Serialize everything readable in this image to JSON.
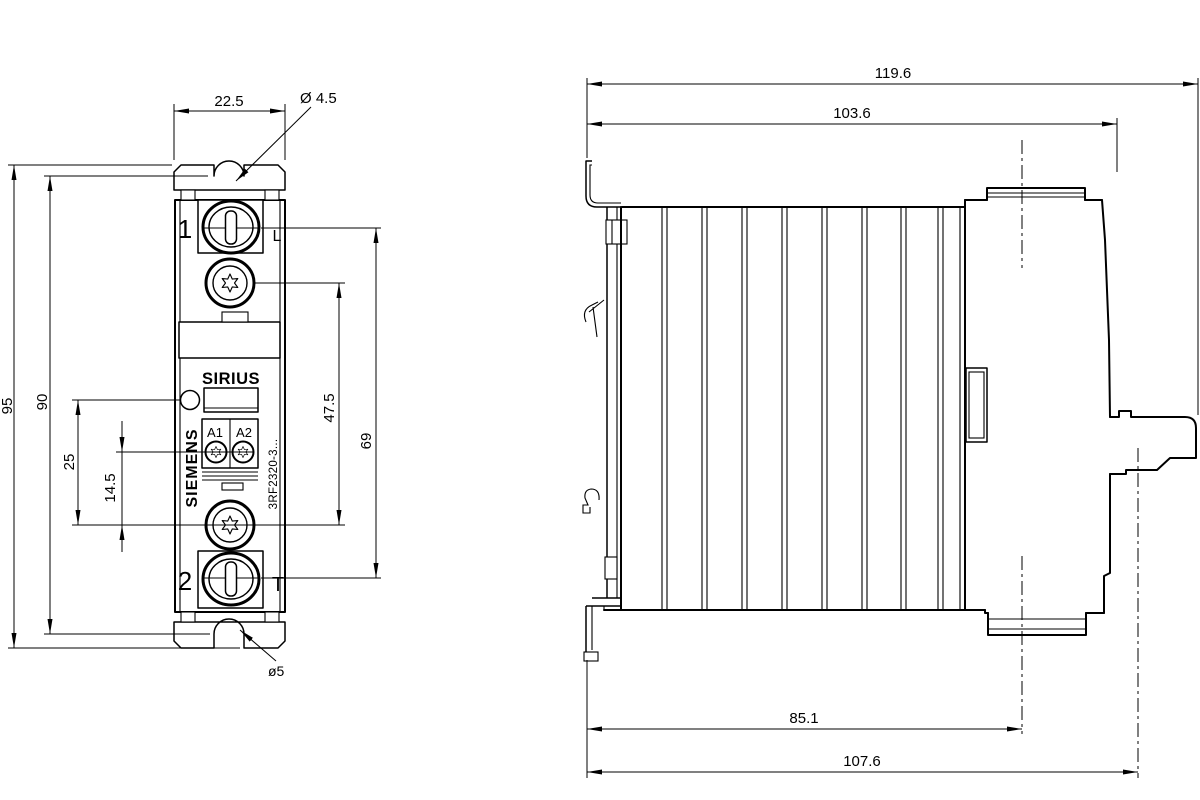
{
  "front_view": {
    "labels": {
      "terminal1": "1",
      "terminal1_line": "L",
      "terminal2": "2",
      "terminal2_line": "T",
      "brand": "SIRIUS",
      "side_brand": "SIEMENS",
      "model": "3RF2320-3...",
      "aux1": "A1",
      "aux2": "A2"
    },
    "dims": {
      "width": "22.5",
      "top_hole": "Ø 4.5",
      "overall_height": "95",
      "hole_spacing": "90",
      "led_to_torx": "25",
      "aux_to_torx": "14.5",
      "torx_spacing": "47.5",
      "terminal_spacing": "69",
      "bottom_hole": "ø5"
    }
  },
  "side_view": {
    "dims": {
      "overall_depth": "119.6",
      "body_depth": "103.6",
      "rail_center": "85.1",
      "terminal_center": "107.6"
    }
  },
  "colors": {
    "line": "#000000",
    "background": "#ffffff"
  }
}
